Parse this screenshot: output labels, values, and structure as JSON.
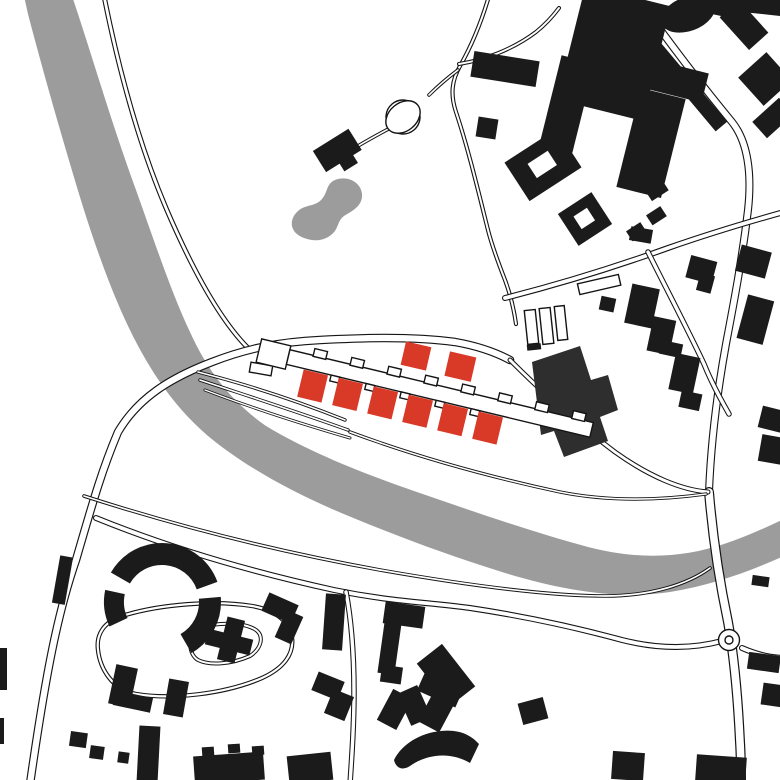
{
  "canvas": {
    "width": 780,
    "height": 780
  },
  "colors": {
    "background": "#ffffff",
    "water": "#9c9c9c",
    "building": "#1b1b1b",
    "building_muted": "#2e2e2e",
    "highlight": "#d93a28",
    "line": "#141414",
    "road": "#ffffff"
  },
  "map": {
    "type": "architectural-site-plan",
    "water_features": [
      "river",
      "pond"
    ],
    "road_features": [
      "riverside-paths",
      "bridge-crossings",
      "roundabout",
      "turning-circle-loop",
      "cul-de-sac-loop",
      "diagonal-streets"
    ],
    "highlighted_buildings": {
      "terrace_row_blocks": 6,
      "detached_blocks": 2,
      "color": "#d93a28"
    },
    "context_buildings": "black figure-ground footprints",
    "labels": []
  }
}
